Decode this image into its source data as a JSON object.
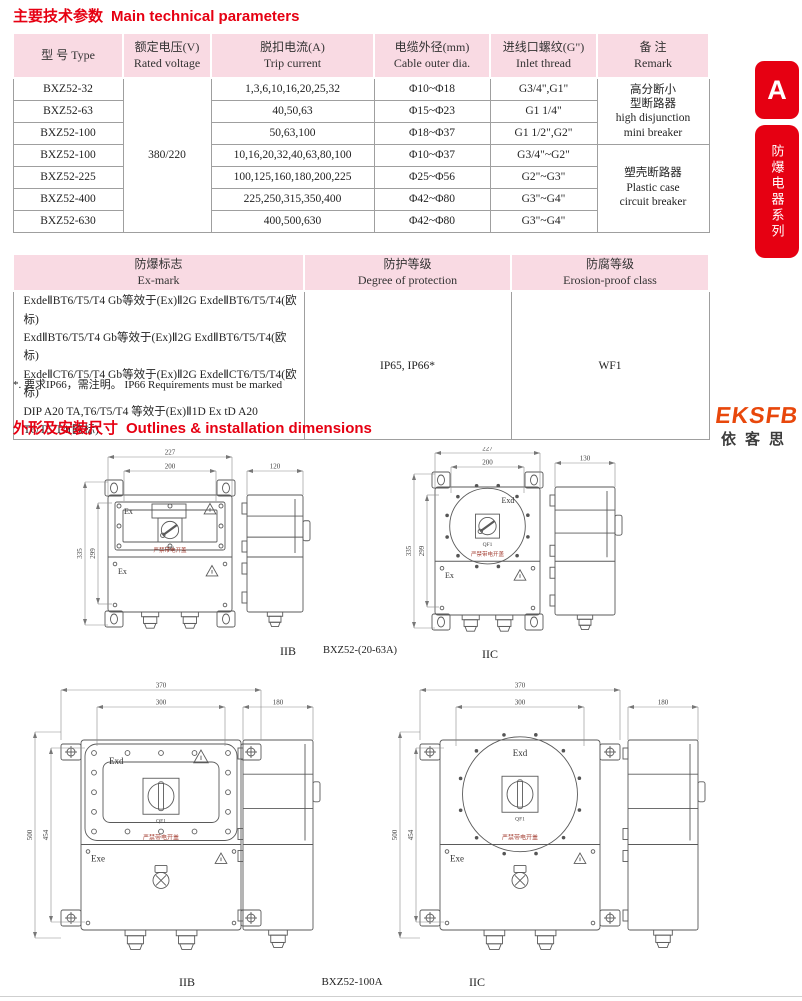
{
  "section1": {
    "title_zh": "主要技术参数",
    "title_en": "Main technical parameters"
  },
  "table1": {
    "headers": [
      {
        "zh": "型 号 Type",
        "en": ""
      },
      {
        "zh": "额定电压(V)",
        "en": "Rated voltage"
      },
      {
        "zh": "脱扣电流(A)",
        "en": "Trip current"
      },
      {
        "zh": "电缆外径(mm)",
        "en": "Cable outer dia."
      },
      {
        "zh": "进线口螺纹(G\")",
        "en": "Inlet thread"
      },
      {
        "zh": "备 注",
        "en": "Remark"
      }
    ],
    "voltage": "380/220",
    "rows": [
      {
        "type": "BXZ52-32",
        "trip": "1,3,6,10,16,20,25,32",
        "cable": "Φ10~Φ18",
        "thread": "G3/4\",G1\""
      },
      {
        "type": "BXZ52-63",
        "trip": "40,50,63",
        "cable": "Φ15~Φ23",
        "thread": "G1 1/4\""
      },
      {
        "type": "BXZ52-100",
        "trip": "50,63,100",
        "cable": "Φ18~Φ37",
        "thread": "G1 1/2\",G2\""
      },
      {
        "type": "BXZ52-100",
        "trip": "10,16,20,32,40,63,80,100",
        "cable": "Φ10~Φ37",
        "thread": "G3/4\"~G2\""
      },
      {
        "type": "BXZ52-225",
        "trip": "100,125,160,180,200,225",
        "cable": "Φ25~Φ56",
        "thread": "G2\"~G3\""
      },
      {
        "type": "BXZ52-400",
        "trip": "225,250,315,350,400",
        "cable": "Φ42~Φ80",
        "thread": "G3\"~G4\""
      },
      {
        "type": "BXZ52-630",
        "trip": "400,500,630",
        "cable": "Φ42~Φ80",
        "thread": "G3\"~G4\""
      }
    ],
    "remark1": {
      "l1": "高分断小",
      "l2": "型断路器",
      "l3": "high disjunction",
      "l4": "mini breaker"
    },
    "remark2": {
      "l1": "塑壳断路器",
      "l2": "Plastic case",
      "l3": "circuit breaker"
    }
  },
  "table2": {
    "headers": [
      {
        "zh": "防爆标志",
        "en": "Ex-mark"
      },
      {
        "zh": "防护等级",
        "en": "Degree of protection"
      },
      {
        "zh": "防腐等级",
        "en": "Erosion-proof class"
      }
    ],
    "ex_mark_lines": [
      "ExdeⅡBT6/T5/T4 Gb等效于(Ex)Ⅱ2G ExdeⅡBT6/T5/T4(欧标)",
      "ExdⅡBT6/T5/T4 Gb等效于(Ex)Ⅱ2G ExdⅡBT6/T5/T4(欧标)",
      "ExdeⅡCT6/T5/T4 Gb等效于(Ex)Ⅱ2G ExdeⅡCT6/T5/T4(欧标)",
      "DIP A20 TA,T6/T5/T4 等效于(Ex)Ⅱ1D Ex tD A20 T6/T5/T4(欧标)"
    ],
    "protection": "IP65, IP66*",
    "erosion": "WF1"
  },
  "note": "*. 要求IP66，需注明。 IP66 Requirements must be marked",
  "section2": {
    "title_zh": "外形及安装尺寸",
    "title_en": "Outlines & installation dimensions"
  },
  "logo": {
    "text": "EKSFB",
    "cn": "依客思"
  },
  "side_tab": {
    "letter": "A",
    "series": "防爆电器系列"
  },
  "colors": {
    "accent_red": "#e60012",
    "header_pink": "#f9dae3",
    "logo_orange": "#e8470b"
  },
  "drawings": {
    "r1l": {
      "caption": "IIB",
      "top_label": "Ex",
      "bottom_label": "Ex",
      "switch_label": "QF1",
      "warning": "严禁带电开盖",
      "dim_outer_w": "227",
      "dim_inner_w": "200",
      "dim_outer_h": "335",
      "dim_inner_h": "299",
      "dim_side_w": "120"
    },
    "row1_center": "BXZ52-(20-63A)",
    "r1r": {
      "caption": "IIC",
      "top_label": "Exd",
      "bottom_label": "Ex",
      "switch_label": "QF1",
      "warning": "严禁带电开盖",
      "dim_outer_w": "227",
      "dim_inner_w": "200",
      "dim_outer_h": "335",
      "dim_inner_h": "299",
      "dim_side_w": "130"
    },
    "r2l": {
      "caption": "IIB",
      "top_label": "Exd",
      "bottom_label": "Exe",
      "switch_label": "QF1",
      "warning": "严禁带电开盖",
      "dim_outer_w": "370",
      "dim_inner_w": "300",
      "dim_outer_h": "500",
      "dim_inner_h": "454",
      "dim_side_w": "180"
    },
    "row2_center": "BXZ52-100A",
    "r2r": {
      "caption": "IIC",
      "top_label": "Exd",
      "bottom_label": "Exe",
      "switch_label": "QF1",
      "warning": "严禁带电开盖",
      "dim_outer_w": "370",
      "dim_inner_w": "300",
      "dim_outer_h": "500",
      "dim_inner_h": "454",
      "dim_side_w": "180"
    }
  }
}
